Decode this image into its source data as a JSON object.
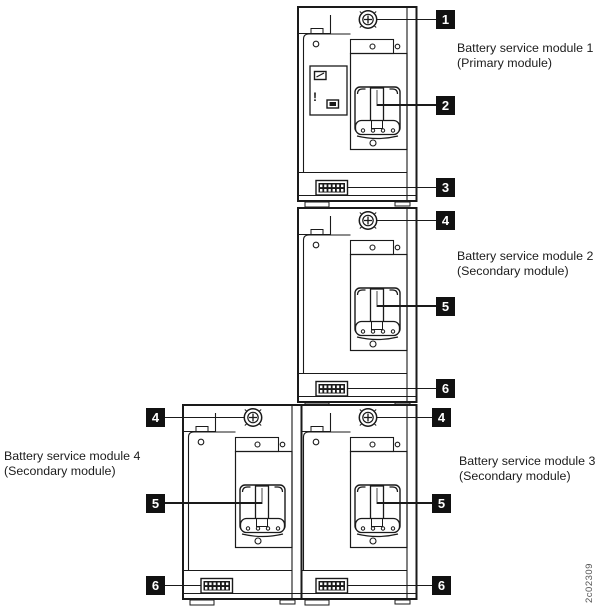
{
  "figure": {
    "watermark": "2c02309",
    "warning_label_exclamation": "!",
    "modules": [
      {
        "label_line1": "Battery service module 1",
        "label_line2": "(Primary module)",
        "callout_screw": "1",
        "callout_handle": "2",
        "callout_connector": "3"
      },
      {
        "label_line1": "Battery service module 2",
        "label_line2": "(Secondary module)",
        "callout_screw": "4",
        "callout_handle": "5",
        "callout_connector": "6"
      },
      {
        "label_line1": "Battery service module 3",
        "label_line2": "(Secondary module)",
        "callout_screw": "4",
        "callout_handle": "5",
        "callout_connector": "6"
      },
      {
        "label_line1": "Battery service module 4",
        "label_line2": "(Secondary module)",
        "callout_screw": "4",
        "callout_handle": "5",
        "callout_connector": "6"
      }
    ],
    "colors": {
      "line": "#1a1a1a",
      "callout_bg": "#111111",
      "callout_text": "#ffffff"
    }
  }
}
